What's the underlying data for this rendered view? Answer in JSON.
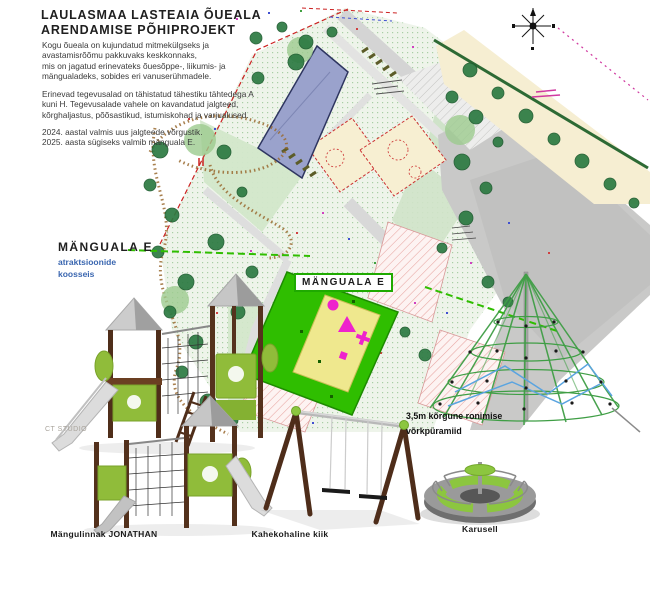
{
  "header": {
    "title_line1": "LAULASMAA LASTEAIA ÕUEALA",
    "title_line2": "ARENDAMISE PÕHIPROJEKT"
  },
  "description": {
    "para1_lines": [
      "Kogu õueala on kujundatud mitmekülgseks ja",
      "avastamisrõõmu pakkuvaks keskkonnaks,",
      "mis on jagatud erinevateks õuesõppe-, liikumis- ja",
      "mängualadeks, sobides eri vanuserühmadele."
    ],
    "para2_lines": [
      "Erinevad tegevusalad on tähistatud tähestiku tähtedega A",
      "kuni H. Tegevusalade vahele on kavandatud jalgteed,",
      "kõrghaljastus, põõsastikud, istumiskohad ja varjualused."
    ],
    "para3_lines": [
      "2024. aastal valmis uus jalgteede võrgustik.",
      "2025. aasta sügiseks valmib mänguala E."
    ]
  },
  "site_plan": {
    "highlight_zone_label": "MÄNGUALA E",
    "north_icon": "compass-rose"
  },
  "equipment_section": {
    "heading": "MÄNGUALA E",
    "subheading_line1": "atraktsioonide",
    "subheading_line2": "koosseis",
    "items": [
      {
        "name": "playground-castle",
        "label": "Mängulinnak JONATHAN"
      },
      {
        "name": "double-swing",
        "label": "Kahekohaline kiik"
      },
      {
        "name": "carousel",
        "label": "Karusell"
      },
      {
        "name": "climbing-net-pyramid",
        "label_line1": "3,5m kõrgune ronimise",
        "label_line2": "võrkpüramiid"
      }
    ],
    "watermark": "CT STUDIO"
  },
  "colors": {
    "highlight_green": "#2fbe00",
    "equipment_green": "#8cc63f",
    "heading_blue": "#3a66b0",
    "wood_brown": "#4f2e1a",
    "building_blue": "#9aa2cc"
  }
}
